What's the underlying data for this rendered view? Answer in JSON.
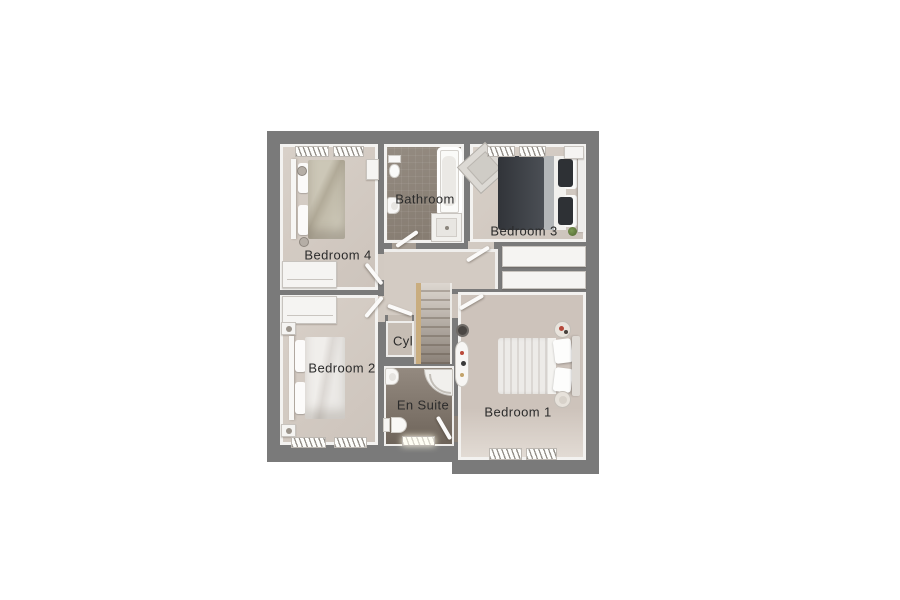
{
  "floorplan": {
    "title_note": "",
    "rooms": [
      {
        "id": "bathroom",
        "label": "Bathroom",
        "furniture": [
          "toilet",
          "sink",
          "bathtub",
          "shower"
        ]
      },
      {
        "id": "bedroom3",
        "label": "Bedroom 3",
        "furniture": [
          "double-bed",
          "desk",
          "shelf",
          "plant",
          "window",
          "built-in-wardrobe"
        ]
      },
      {
        "id": "bedroom4",
        "label": "Bedroom 4",
        "furniture": [
          "double-bed",
          "wardrobe",
          "radiator",
          "window",
          "stools"
        ]
      },
      {
        "id": "cyl",
        "label": "Cyl",
        "furniture": []
      },
      {
        "id": "bedroom2",
        "label": "Bedroom 2",
        "furniture": [
          "double-bed",
          "wardrobe",
          "bedside-tables",
          "window"
        ]
      },
      {
        "id": "ensuite",
        "label": "En Suite",
        "furniture": [
          "toilet",
          "sink",
          "quadrant-shower",
          "window"
        ]
      },
      {
        "id": "bedroom1",
        "label": "Bedroom 1",
        "furniture": [
          "double-bed",
          "dressing-table",
          "stool",
          "round-bedside-tables",
          "window",
          "built-in-wardrobe"
        ]
      }
    ],
    "landing": {
      "furniture": [
        "staircase"
      ]
    },
    "colors": {
      "wall": "#7a7a7a",
      "inner_face": "#f3f2f0",
      "bedroom_floor": "#d2c9c1",
      "bathroom_floor": "#8d8378",
      "landing_floor": "#d3cbc3",
      "stair_stringer": "#c9ad7f",
      "label_text": "#2b2b2b",
      "background": "#ffffff"
    }
  }
}
